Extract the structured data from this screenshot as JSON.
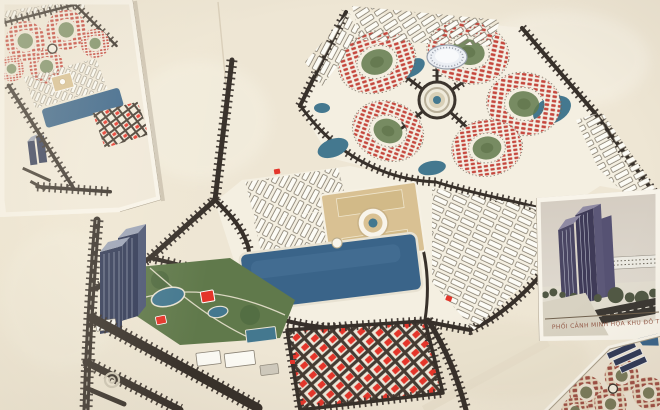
{
  "colors": {
    "paper": "#eee6d4",
    "paperlight": "#f5f0e3",
    "margin": "#f8f4ea",
    "insetedge": "#a99e8a",
    "road": "#37302a",
    "lake": "#3a6489",
    "teal": "#44788f",
    "park": "#60794b",
    "villa": "#c5473d",
    "villabright": "#e4352a",
    "tan": "#d9c193",
    "slab": "#fcfbf5",
    "navy": "#313a58",
    "navyl": "#9ba3b7",
    "caption": "#8a4a38",
    "skytop": "#d4ccc1",
    "skybot": "#dfd9cf",
    "photoline": "#71624f"
  },
  "insets": {
    "bottom_right": {
      "caption": "PHỐI CẢNH MINH HỌA KHU ĐÔ THỊ"
    }
  }
}
